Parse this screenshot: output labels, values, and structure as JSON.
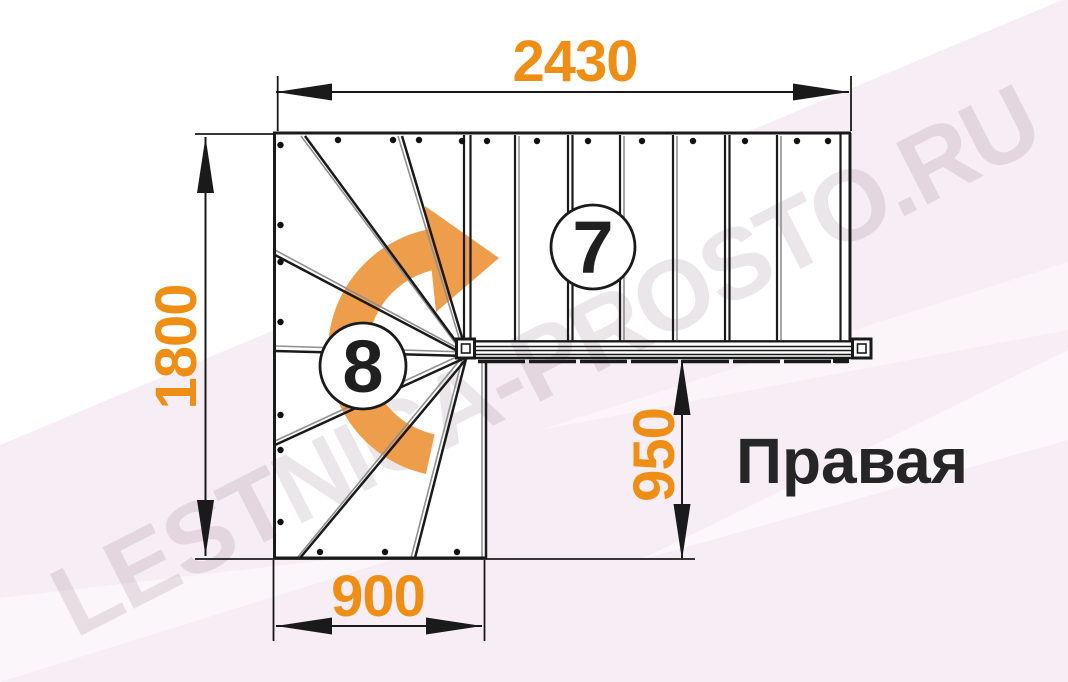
{
  "watermark": {
    "text": "LESTNICA-PROSTO.RU"
  },
  "orientation_label": "Правая",
  "dimensions": {
    "total_width_mm": "2430",
    "total_depth_mm": "1800",
    "winder_width_mm": "900",
    "flight_offset_mm": "950"
  },
  "step_counts": {
    "straight_flight": "7",
    "winder": "8"
  },
  "plan": {
    "type": "L-shaped stair plan, right-turn",
    "straight_treads": 7,
    "winder_treads": 8,
    "rotation_direction": "clockwise-up-right"
  },
  "colors": {
    "dimension_text_orange": "#EF8E14",
    "rotation_arrow_orange": "#EE9E4A",
    "line_black": "#1A1A1A",
    "watermark_pink": "#F7EDF4",
    "watermark_text": "rgba(110,80,100,0.14)"
  }
}
